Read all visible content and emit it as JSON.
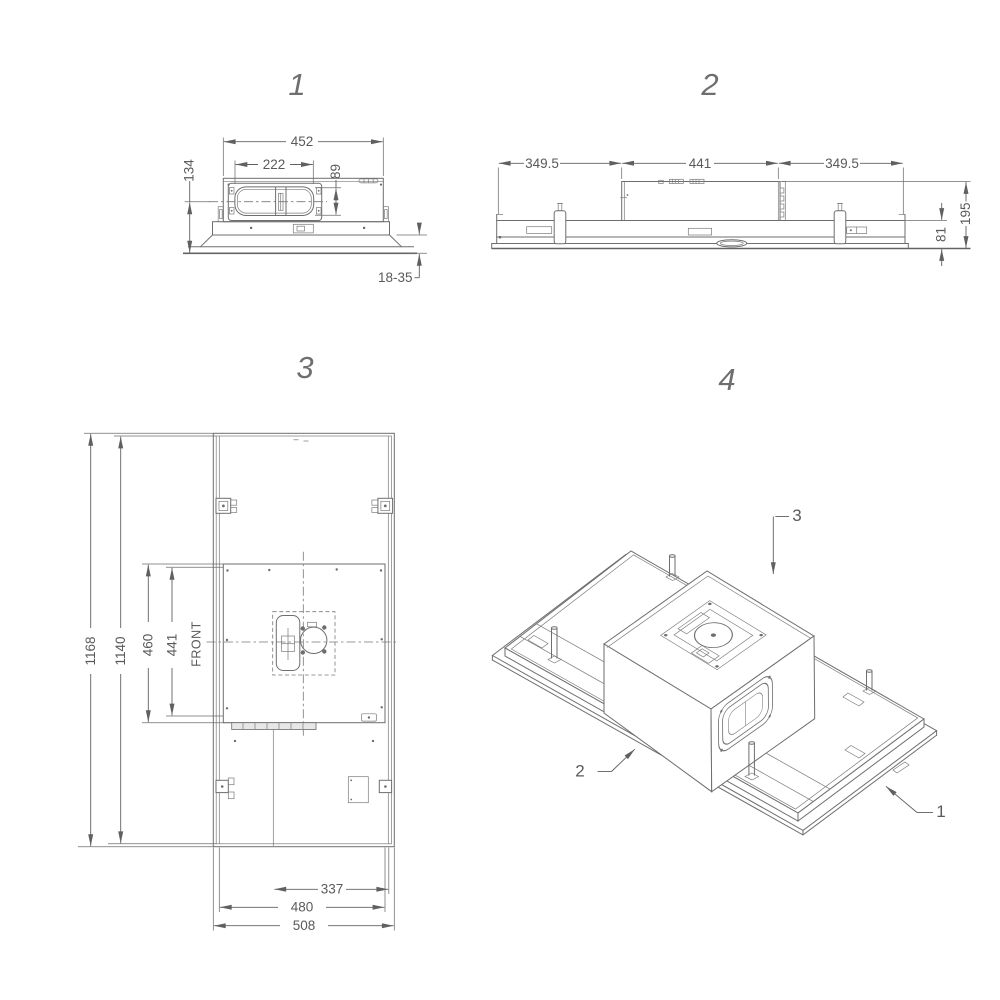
{
  "drawing": {
    "background_color": "#ffffff",
    "line_color": "#6e6e6e",
    "text_color": "#5a5a5a"
  },
  "views": {
    "view1": {
      "label": "1",
      "dims": {
        "overall_width": "452",
        "duct_width": "222",
        "duct_height": "89",
        "body_height": "134",
        "ceiling_thickness": "18-35"
      }
    },
    "view2": {
      "label": "2",
      "dims": {
        "left_section": "349.5",
        "center_section": "441",
        "right_section": "349.5",
        "overall_height": "195",
        "base_height": "81"
      }
    },
    "view3": {
      "label": "3",
      "front_label": "FRONT",
      "dims": {
        "overall_length": "1168",
        "inner_length": "1140",
        "plate_length": "460",
        "plate_inner_length": "441",
        "cutout_width": "337",
        "inner_width": "480",
        "overall_width": "508"
      }
    },
    "view4": {
      "label": "4",
      "callouts": {
        "top": "3",
        "left": "2",
        "right": "1"
      }
    }
  }
}
